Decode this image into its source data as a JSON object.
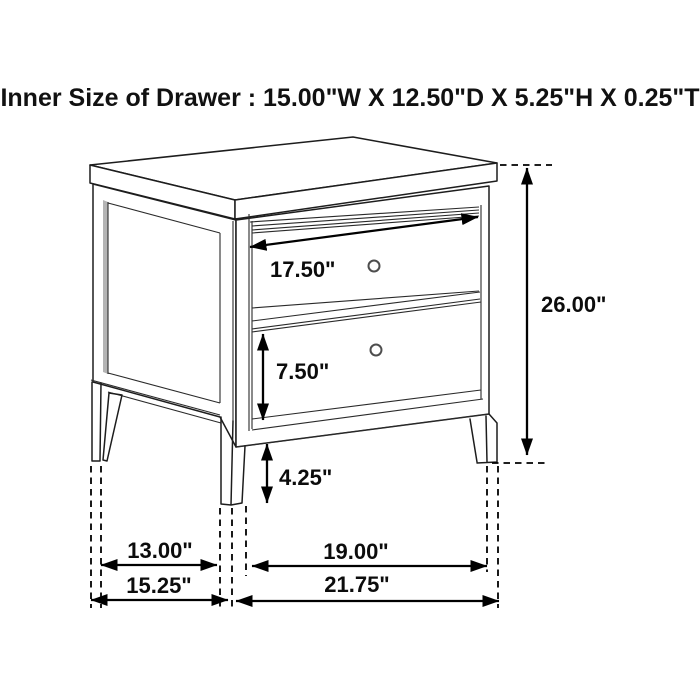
{
  "title": "Inner Size of Drawer : 15.00\"W X 12.50\"D X 5.25\"H X 0.25\"T",
  "dimension_labels": {
    "drawer_width": "17.50\"",
    "overall_height": "26.00\"",
    "drawer_face_height": "7.50\"",
    "leg_height": "4.25\"",
    "side_leg_span": "13.00\"",
    "overall_depth": "15.25\"",
    "front_leg_span": "19.00\"",
    "overall_width": "21.75\""
  },
  "colors": {
    "background": "#ffffff",
    "line": "#1d1d1d",
    "dimension": "#000000",
    "text": "#0c0c0c",
    "panel_shade": "#b4b4b4"
  },
  "drawing": {
    "subject": "two-drawer nightstand line drawing with dimension arrows",
    "drawer_count": 2,
    "knob_count": 2
  }
}
